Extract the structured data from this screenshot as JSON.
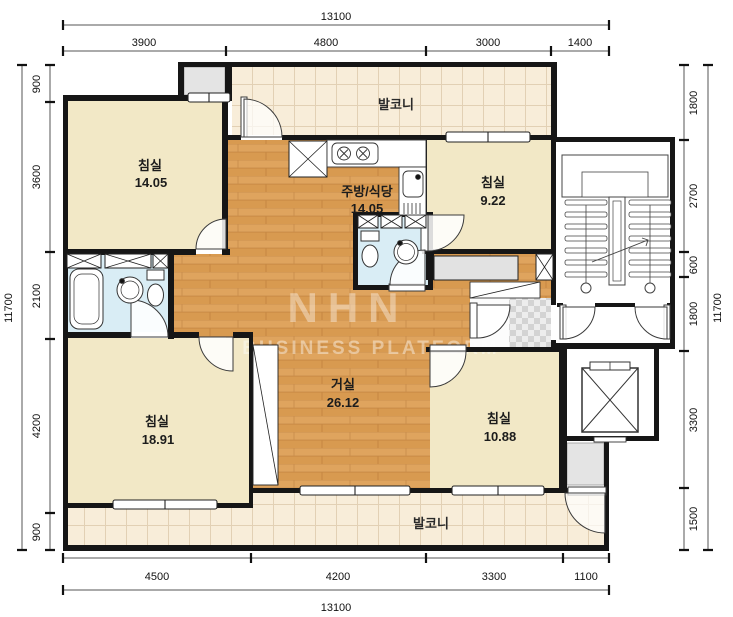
{
  "title": "apartment-floor-plan",
  "watermark": {
    "logo": "NHN",
    "text": "BUSINESS PLATFORM"
  },
  "rooms": {
    "bedroom_tl": {
      "name": "침실",
      "area": "14.05"
    },
    "bedroom_tr": {
      "name": "침실",
      "area": "9.22"
    },
    "bedroom_bl": {
      "name": "침실",
      "area": "18.91"
    },
    "bedroom_br": {
      "name": "침실",
      "area": "10.88"
    },
    "kitchen": {
      "name": "주방/식당",
      "area": "14.05"
    },
    "living": {
      "name": "거실",
      "area": "26.12"
    },
    "balcony_top": {
      "name": "발코니"
    },
    "balcony_bottom": {
      "name": "발코니"
    }
  },
  "dimensions": {
    "top": {
      "total": "13100",
      "segments": [
        "3900",
        "4800",
        "3000",
        "1400"
      ]
    },
    "bottom": {
      "total": "13100",
      "segments": [
        "4500",
        "4200",
        "3300",
        "1100"
      ]
    },
    "left": {
      "total": "11700",
      "segments": [
        "900",
        "3600",
        "2100",
        "4200",
        "900"
      ]
    },
    "right": {
      "total": "11700",
      "segments": [
        "1800",
        "2700",
        "600",
        "1800",
        "3300",
        "1500"
      ]
    }
  },
  "colors": {
    "wall": "#161616",
    "wood_floor": "#dfa45e",
    "bedroom_floor": "#f2e8c6",
    "bathroom_floor": "#d9edf5",
    "balcony_floor": "#f8edd9",
    "closet_gray": "#e4e4e4"
  }
}
